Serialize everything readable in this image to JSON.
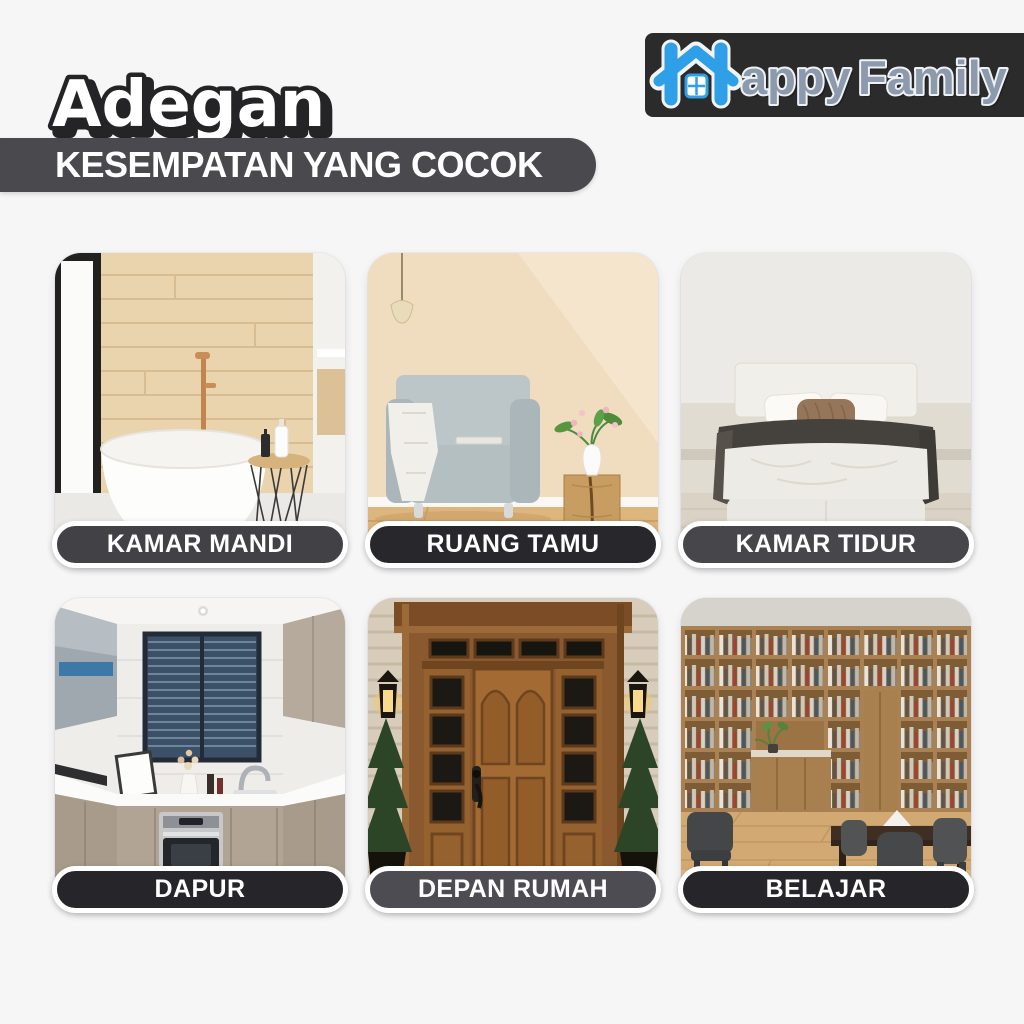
{
  "page": {
    "background": "#f6f6f7"
  },
  "header": {
    "title": "Adegan",
    "banner": {
      "text": "KESEMPATAN YANG COCOK",
      "background": "#4a4a4e",
      "text_color": "#ffffff"
    },
    "logo": {
      "word_first_letter": "H",
      "word_rest": "appy",
      "word_second": "Family",
      "background": "#2b2b2b",
      "blue": "#2f9fe8",
      "slate": "#8c9aac",
      "icon": "house-icon"
    }
  },
  "cards": [
    {
      "label": "KAMAR MANDI",
      "scene": "bathroom",
      "pill_color": "#424246"
    },
    {
      "label": "RUANG TAMU",
      "scene": "living-room",
      "pill_color": "#28282c"
    },
    {
      "label": "KAMAR TIDUR",
      "scene": "bedroom",
      "pill_color": "#47474b"
    },
    {
      "label": "DAPUR",
      "scene": "kitchen",
      "pill_color": "#26262a"
    },
    {
      "label": "DEPAN RUMAH",
      "scene": "front-door",
      "pill_color": "#4c4c52"
    },
    {
      "label": "BELAJAR",
      "scene": "study",
      "pill_color": "#26262a"
    }
  ]
}
